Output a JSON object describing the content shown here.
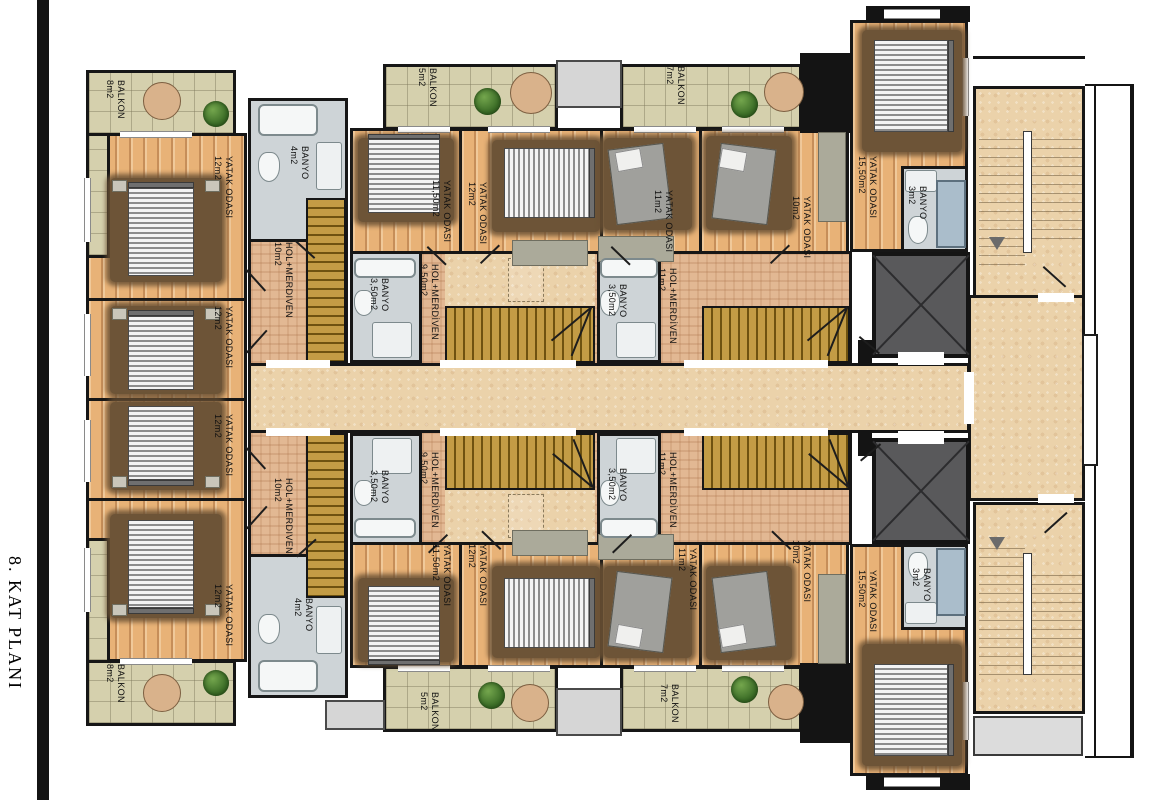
{
  "title": "8. KAT PLANI",
  "colors": {
    "wall": "#141414",
    "wood_floor": "#e8b277",
    "balcony_tile": "#d5d0ad",
    "corridor": "#ebd2aa",
    "unit_hall": "#e2b893",
    "stairs_wood": "#b18a33",
    "bath_floor": "#ced4d7",
    "elevator": "#59595b",
    "rug": "#6d5437",
    "tree": "#3c6d27",
    "shower": "#aabdcb"
  },
  "rooms": {
    "balkon_tl": {
      "name": "BALKON",
      "area": "8m2"
    },
    "balkon_bl": {
      "name": "BALKON",
      "area": "8m2"
    },
    "bed_l1": {
      "name": "YATAK ODASI",
      "area": "12m2"
    },
    "bed_l2": {
      "name": "YATAK ODASI",
      "area": "12m2"
    },
    "bed_l3": {
      "name": "YATAK ODASI",
      "area": "12m2"
    },
    "bed_l4": {
      "name": "YATAK ODASI",
      "area": "12m2"
    },
    "banyo_l_top": {
      "name": "BANYO",
      "area": "4m2"
    },
    "banyo_l_bot": {
      "name": "BANYO",
      "area": "4m2"
    },
    "hol_l_top": {
      "name": "HOL+MERDIVEN",
      "area": "10m2"
    },
    "hol_l_bot": {
      "name": "HOL+MERDIVEN",
      "area": "10m2"
    },
    "balkon_c_top": {
      "name": "BALKON",
      "area": "5m2"
    },
    "balkon_c_bot": {
      "name": "BALKON",
      "area": "5m2"
    },
    "bed_c1_top": {
      "name": "YATAK ODASI",
      "area": "11,50m2"
    },
    "bed_c1_bot": {
      "name": "YATAK ODASI",
      "area": "11,50m2"
    },
    "bed_c2_top": {
      "name": "YATAK ODASI",
      "area": "12m2"
    },
    "bed_c2_bot": {
      "name": "YATAK ODASI",
      "area": "12m2"
    },
    "banyo_c_top": {
      "name": "BANYO",
      "area": "3,50m2"
    },
    "banyo_c_bot": {
      "name": "BANYO",
      "area": "3,50m2"
    },
    "hol_c_top": {
      "name": "HOL+MERDİVEN",
      "area": "9,50m2"
    },
    "hol_c_bot": {
      "name": "HOL+MERDİVEN",
      "area": "9,50m2"
    },
    "bed_r1_top": {
      "name": "YATAK ODASI",
      "area": "11m2"
    },
    "bed_r1_bot": {
      "name": "YATAK ODASI",
      "area": "11m2"
    },
    "bed_r2_top": {
      "name": "YATAK ODASI",
      "area": "10m2"
    },
    "bed_r2_bot": {
      "name": "YATAK ODASI",
      "area": "10m2"
    },
    "banyo_r_top": {
      "name": "BANYO",
      "area": "3,50m2"
    },
    "banyo_r_bot": {
      "name": "BANYO",
      "area": "3,50m2"
    },
    "hol_r_top": {
      "name": "HOL+MERDİVEN",
      "area": "11m2"
    },
    "hol_r_bot": {
      "name": "HOL+MERDİVEN",
      "area": "11m2"
    },
    "balkon_r_top": {
      "name": "BALKON",
      "area": "7m2"
    },
    "balkon_r_bot": {
      "name": "BALKON",
      "area": "7m2"
    },
    "bed_fr_top": {
      "name": "YATAK ODASI",
      "area": "15,50m2"
    },
    "bed_fr_bot": {
      "name": "YATAK ODASI",
      "area": "15,50m2"
    },
    "banyo_fr_top": {
      "name": "BANYO",
      "area": "3m2"
    },
    "banyo_fr_bot": {
      "name": "BANYO",
      "area": "3m2"
    }
  }
}
